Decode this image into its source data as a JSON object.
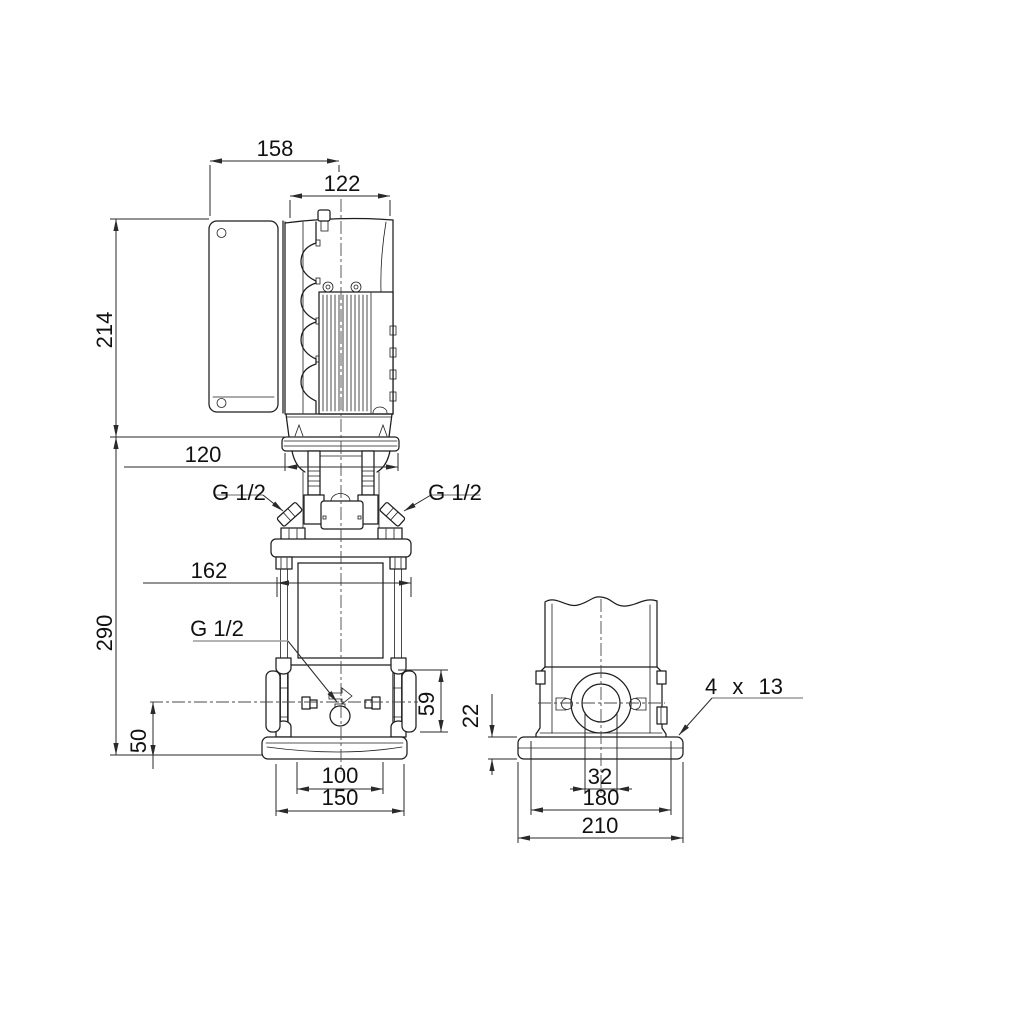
{
  "colors": {
    "background": "#ffffff",
    "line": "#1d1d1d",
    "dim_line": "#2a2a2a",
    "leader": "#9b9b9b",
    "centerline": "#4a4a4a",
    "text": "#111111"
  },
  "dimensions": {
    "front": {
      "width_overall": "158",
      "width_motor": "122",
      "height_motor": "214",
      "width_motor_flange": "120",
      "height_pump": "290",
      "width_chambers": "162",
      "height_port_axis": "50",
      "height_port_flange": "59",
      "base_holes_spacing": "100",
      "base_width": "150"
    },
    "side": {
      "base_plate_thickness": "22",
      "width_port_bore": "32",
      "base_holes_spacing": "180",
      "base_depth": "210",
      "base_hole_note": "4 x 13"
    },
    "connections": {
      "gauge_left": "G 1/2",
      "gauge_right": "G 1/2",
      "drain": "G 1/2"
    }
  }
}
